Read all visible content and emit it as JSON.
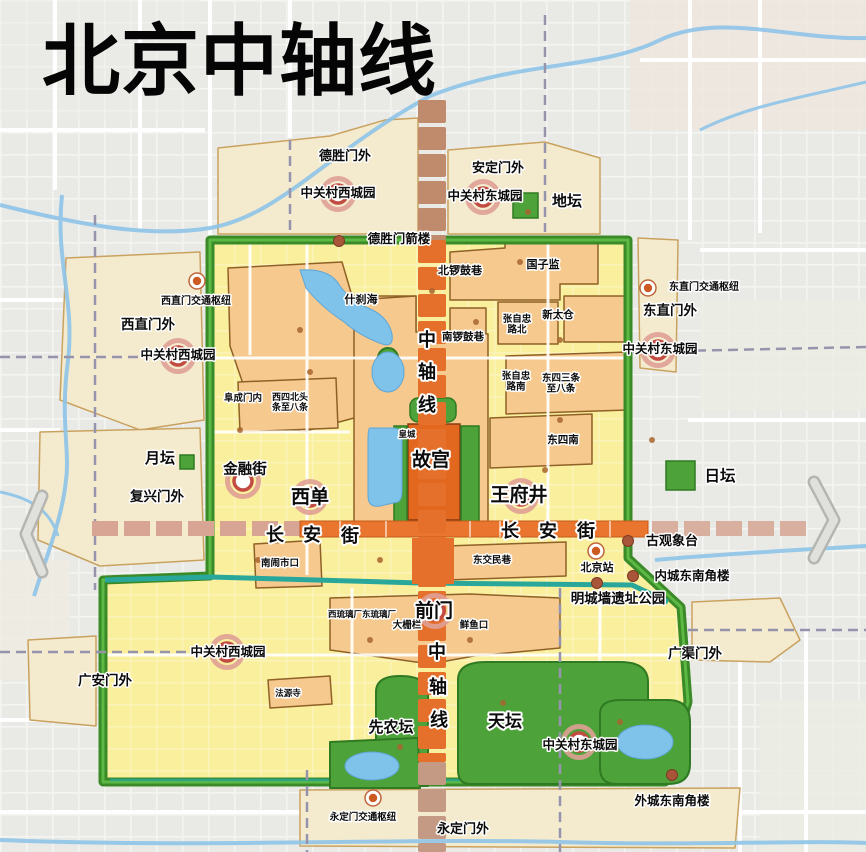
{
  "title": "北京中轴线",
  "colors": {
    "background": "#e9eae6",
    "old_city_fill": "#f9ef9c",
    "greenbelt_ring": "#3b8a28",
    "moat_teal": "#2aa79b",
    "historic_district": "#f6c98f",
    "park_green": "#4da33a",
    "water_blue": "#7fc2ea",
    "axis_orange": "#e4702b",
    "axis_muted": "#c08a6d",
    "changan_orange": "#e9752e",
    "changan_dashed": "#d8a493",
    "suburb_cream": "#f4ebcf",
    "landmark_ring_red": "#c24b42",
    "landmark_dot_brown": "#a8553a",
    "subway_dash": "#9693ad"
  },
  "labels": [
    {
      "name": "deshengmenwai",
      "text": "德胜门外",
      "x": 345,
      "y": 160,
      "size": 13
    },
    {
      "name": "andingmenwai",
      "text": "安定门外",
      "x": 498,
      "y": 172,
      "size": 13
    },
    {
      "name": "zgc-west-park-top",
      "text": "中关村西城园",
      "x": 338,
      "y": 197,
      "size": 12.5
    },
    {
      "name": "zgc-east-park-top",
      "text": "中关村东城园",
      "x": 485,
      "y": 200,
      "size": 12.5
    },
    {
      "name": "ditan",
      "text": "地坛",
      "x": 567,
      "y": 206,
      "size": 15
    },
    {
      "name": "deshengmen-jianlou",
      "text": "德胜门箭楼",
      "x": 399,
      "y": 243,
      "size": 12.5
    },
    {
      "name": "beiluoguxiang",
      "text": "北锣鼓巷",
      "x": 460,
      "y": 274,
      "size": 11
    },
    {
      "name": "guozijian",
      "text": "国子监",
      "x": 543,
      "y": 268,
      "size": 11
    },
    {
      "name": "xizhimen-hub",
      "text": "西直门交通枢纽",
      "x": 196,
      "y": 304,
      "size": 10
    },
    {
      "name": "dongzhimen-hub",
      "text": "东直门交通枢纽",
      "x": 704,
      "y": 290,
      "size": 10
    },
    {
      "name": "xizhimenwai",
      "text": "西直门外",
      "x": 148,
      "y": 329,
      "size": 13.5
    },
    {
      "name": "dongzhimenwai",
      "text": "东直门外",
      "x": 670,
      "y": 315,
      "size": 13.5
    },
    {
      "name": "shichahai",
      "text": "什刹海",
      "x": 361,
      "y": 303,
      "size": 11
    },
    {
      "name": "zgc-west-park-mid",
      "text": "中关村西城园",
      "x": 178,
      "y": 359,
      "size": 12.5
    },
    {
      "name": "zgc-east-park-mid",
      "text": "中关村东城园",
      "x": 660,
      "y": 353,
      "size": 12.5
    },
    {
      "name": "xintaicang",
      "text": "新太仓",
      "x": 558,
      "y": 318,
      "size": 10.5
    },
    {
      "name": "zhangzizhong-north",
      "text": "张自忠\n路北",
      "x": 517,
      "y": 322,
      "size": 9.5
    },
    {
      "name": "nanluoguxiang",
      "text": "南锣鼓巷",
      "x": 463,
      "y": 340,
      "size": 10.5
    },
    {
      "name": "zhangzizhong-south",
      "text": "张自忠\n路南",
      "x": 516,
      "y": 379,
      "size": 9.5
    },
    {
      "name": "dongsi-3-8",
      "text": "东四三条\n至八条",
      "x": 561,
      "y": 381,
      "size": 9.5
    },
    {
      "name": "fuchengmennei",
      "text": "阜成门内",
      "x": 243,
      "y": 401,
      "size": 9.5
    },
    {
      "name": "xisibei-1-8",
      "text": "西四北头\n条至八条",
      "x": 290,
      "y": 400,
      "size": 9
    },
    {
      "name": "axis-top-1",
      "text": "中",
      "x": 427,
      "y": 346,
      "size": 18
    },
    {
      "name": "axis-top-2",
      "text": "轴",
      "x": 427,
      "y": 378,
      "size": 18
    },
    {
      "name": "axis-top-3",
      "text": "线",
      "x": 427,
      "y": 411,
      "size": 18
    },
    {
      "name": "huangcheng",
      "text": "皇城",
      "x": 407,
      "y": 437,
      "size": 8.5
    },
    {
      "name": "dongsinan",
      "text": "东四南",
      "x": 563,
      "y": 443,
      "size": 10.5
    },
    {
      "name": "gugong",
      "text": "故宫",
      "x": 431,
      "y": 466,
      "size": 19
    },
    {
      "name": "yuetan",
      "text": "月坛",
      "x": 160,
      "y": 463,
      "size": 15
    },
    {
      "name": "jinrongjie",
      "text": "金融街",
      "x": 245,
      "y": 474,
      "size": 14.5
    },
    {
      "name": "fuxingmenwai",
      "text": "复兴门外",
      "x": 157,
      "y": 501,
      "size": 13.5
    },
    {
      "name": "xidan",
      "text": "西单",
      "x": 310,
      "y": 503,
      "size": 19
    },
    {
      "name": "wangfujing",
      "text": "王府井",
      "x": 519,
      "y": 501,
      "size": 19
    },
    {
      "name": "ritan",
      "text": "日坛",
      "x": 720,
      "y": 481,
      "size": 15.5
    },
    {
      "name": "changanjie-west-1",
      "text": "长",
      "x": 275,
      "y": 541,
      "size": 18
    },
    {
      "name": "changanjie-west-2",
      "text": "安",
      "x": 312,
      "y": 541,
      "size": 18
    },
    {
      "name": "changanjie-west-3",
      "text": "街",
      "x": 350,
      "y": 542,
      "size": 18
    },
    {
      "name": "changanjie-east-1",
      "text": "长",
      "x": 510,
      "y": 537,
      "size": 18
    },
    {
      "name": "changanjie-east-2",
      "text": "安",
      "x": 548,
      "y": 537,
      "size": 18
    },
    {
      "name": "changanjie-east-3",
      "text": "街",
      "x": 586,
      "y": 537,
      "size": 18
    },
    {
      "name": "guguanxiangtai",
      "text": "古观象台",
      "x": 672,
      "y": 545,
      "size": 13
    },
    {
      "name": "nannaoshikou",
      "text": "南闹市口",
      "x": 280,
      "y": 566,
      "size": 9.5
    },
    {
      "name": "dongjiaominxiang",
      "text": "东交民巷",
      "x": 492,
      "y": 563,
      "size": 9.5
    },
    {
      "name": "beijingzhan",
      "text": "北京站",
      "x": 597,
      "y": 571,
      "size": 11
    },
    {
      "name": "neicheng-dongnan-jiaolou",
      "text": "内城东南角楼",
      "x": 692,
      "y": 580,
      "size": 12.5
    },
    {
      "name": "mingchengqiang-park",
      "text": "明城墙遗址公园",
      "x": 618,
      "y": 603,
      "size": 13.5
    },
    {
      "name": "liulichang",
      "text": "西琉璃厂东琉璃厂",
      "x": 362,
      "y": 617,
      "size": 8.5
    },
    {
      "name": "qianmen",
      "text": "前门",
      "x": 434,
      "y": 617,
      "size": 19
    },
    {
      "name": "dashilar",
      "text": "大栅栏",
      "x": 407,
      "y": 628,
      "size": 9.5
    },
    {
      "name": "xianyukou",
      "text": "鲜鱼口",
      "x": 474,
      "y": 628,
      "size": 9.5
    },
    {
      "name": "zgc-west-park-bottom",
      "text": "中关村西城园",
      "x": 228,
      "y": 656,
      "size": 12.5
    },
    {
      "name": "guangqumenwai",
      "text": "广渠门外",
      "x": 695,
      "y": 658,
      "size": 13.5
    },
    {
      "name": "guanganmenwai",
      "text": "广安门外",
      "x": 105,
      "y": 685,
      "size": 13.5
    },
    {
      "name": "fayuansi",
      "text": "法源寺",
      "x": 288,
      "y": 696,
      "size": 8.5
    },
    {
      "name": "axis-bottom-1",
      "text": "中",
      "x": 437,
      "y": 658,
      "size": 18
    },
    {
      "name": "axis-bottom-2",
      "text": "轴",
      "x": 438,
      "y": 693,
      "size": 18
    },
    {
      "name": "axis-bottom-3",
      "text": "线",
      "x": 439,
      "y": 726,
      "size": 18
    },
    {
      "name": "xiannongtan",
      "text": "先农坛",
      "x": 391,
      "y": 732,
      "size": 15
    },
    {
      "name": "tiantan",
      "text": "天坛",
      "x": 505,
      "y": 727,
      "size": 17
    },
    {
      "name": "zgc-east-park-bottom",
      "text": "中关村东城园",
      "x": 580,
      "y": 749,
      "size": 12.5
    },
    {
      "name": "waicheng-dongnan-jiaolou",
      "text": "外城东南角楼",
      "x": 672,
      "y": 805,
      "size": 12.5
    },
    {
      "name": "yongdingmen-hub",
      "text": "永定门交通枢纽",
      "x": 363,
      "y": 820,
      "size": 9.5
    },
    {
      "name": "yongdingmenwai",
      "text": "永定门外",
      "x": 463,
      "y": 833,
      "size": 13
    }
  ],
  "markers": {
    "targets": [
      {
        "name": "zgc-west-top-marker",
        "x": 338,
        "y": 194
      },
      {
        "name": "zgc-east-top-marker",
        "x": 483,
        "y": 197
      },
      {
        "name": "zgc-west-mid-marker",
        "x": 178,
        "y": 356
      },
      {
        "name": "zgc-east-mid-marker",
        "x": 658,
        "y": 350
      },
      {
        "name": "jinrongjie-marker",
        "x": 243,
        "y": 481
      },
      {
        "name": "xidan-marker",
        "x": 310,
        "y": 497
      },
      {
        "name": "wangfujing-marker",
        "x": 521,
        "y": 496
      },
      {
        "name": "qianmen-marker",
        "x": 435,
        "y": 611
      },
      {
        "name": "zgc-west-bottom-marker",
        "x": 227,
        "y": 652
      },
      {
        "name": "zgc-east-bottom-marker",
        "x": 579,
        "y": 742
      }
    ],
    "hubs": [
      {
        "name": "xizhimen-hub-marker",
        "x": 197,
        "y": 281
      },
      {
        "name": "dongzhimen-hub-marker",
        "x": 648,
        "y": 288
      },
      {
        "name": "beijingzhan-marker",
        "x": 596,
        "y": 551
      },
      {
        "name": "yongdingmen-hub-marker",
        "x": 373,
        "y": 798
      }
    ],
    "dots": [
      {
        "name": "deshengmen-jianlou-dot",
        "x": 339,
        "y": 241
      },
      {
        "name": "guguanxiangtai-dot",
        "x": 628,
        "y": 541
      },
      {
        "name": "neicheng-jiaolou-dot",
        "x": 633,
        "y": 576
      },
      {
        "name": "dongbianmen-dot",
        "x": 597,
        "y": 583
      },
      {
        "name": "waicheng-jiaolou-dot",
        "x": 672,
        "y": 775
      }
    ],
    "squares": [
      {
        "name": "ditan-park-square",
        "x": 513,
        "y": 193,
        "s": 25
      },
      {
        "name": "ritan-park-square",
        "x": 666,
        "y": 461,
        "s": 29
      },
      {
        "name": "yuetan-park-square",
        "x": 180,
        "y": 455,
        "s": 14
      }
    ],
    "minor_dots": [
      [
        310,
        372
      ],
      [
        432,
        291
      ],
      [
        520,
        262
      ],
      [
        476,
        322
      ],
      [
        560,
        420
      ],
      [
        300,
        330
      ],
      [
        258,
        560
      ],
      [
        370,
        640
      ],
      [
        470,
        640
      ],
      [
        652,
        440
      ],
      [
        528,
        212
      ],
      [
        503,
        703
      ],
      [
        400,
        747
      ],
      [
        620,
        722
      ],
      [
        545,
        470
      ],
      [
        380,
        560
      ],
      [
        240,
        430
      ],
      [
        560,
        340
      ]
    ]
  }
}
